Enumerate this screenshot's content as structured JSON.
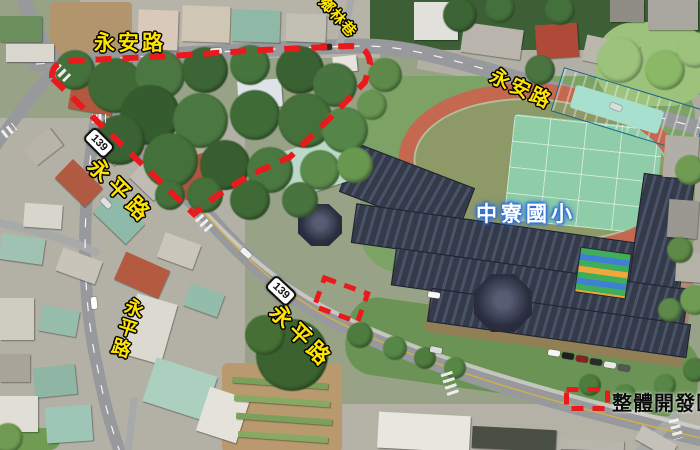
{
  "figure": {
    "type": "annotated-aerial-map",
    "school_label": "中寮國小",
    "road_labels": {
      "yongan_top_left": "永安路",
      "yongan_right": "永安路",
      "yongping_diag_upper": "永平路",
      "yongping_diag_lower": "永平路",
      "yongping_vertical": "永平路",
      "xianglin_lane": "鄉林巷"
    },
    "route_badges": [
      {
        "number": "139"
      },
      {
        "number": "139"
      }
    ],
    "legend": {
      "swatch": "red-dashed-rectangle",
      "label": "整體開發區"
    },
    "colors": {
      "annotation_red": "#ea1a1c",
      "road_label_yellow": "#ffe400",
      "school_label_fill": "#ffffff",
      "school_label_glow": "#2f6fd8",
      "legend_text": "#0b0b0b"
    }
  }
}
